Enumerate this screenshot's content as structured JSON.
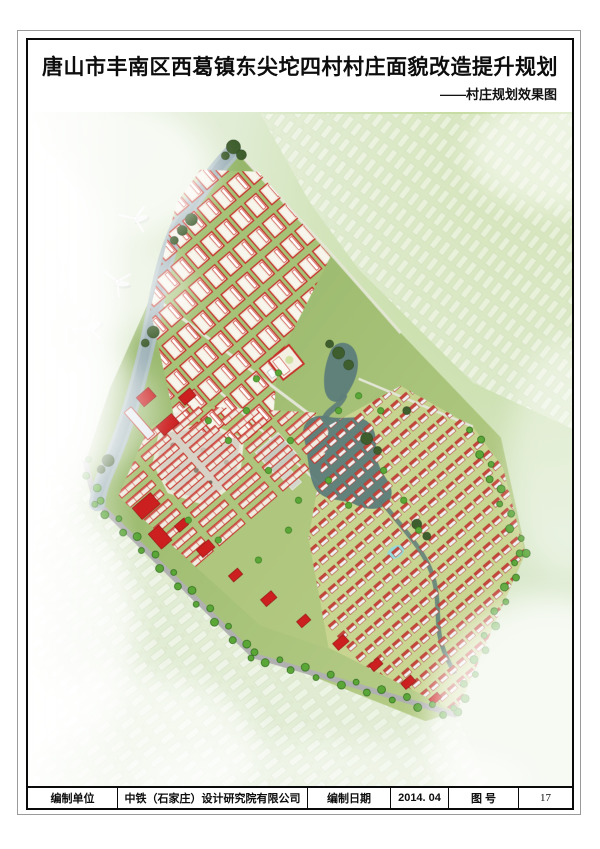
{
  "page": {
    "title": "唐山市丰南区西葛镇东尖坨四村村庄面貌改造提升规划",
    "subtitle": "——村庄规划效果图"
  },
  "footer": {
    "unit_label": "编制单位",
    "unit_value": "中铁（石家庄）设计研究院有限公司",
    "date_label": "编制日期",
    "date_value": "2014. 04",
    "figno_label": "图 号",
    "figno_value": "17"
  },
  "map": {
    "colors": {
      "bg_green_pale": "#dfeccf",
      "bg_green_bright": "#bdd794",
      "village_green_dark": "#8fb266",
      "village_green": "#a2bf74",
      "village_green_light": "#bcd08d",
      "river_blue": "#aebfc5",
      "river_core": "#93a9b0",
      "pond_teal": "#5d7c7a",
      "pond_cyan": "#8fd9e2",
      "house_red": "#c63028",
      "accent_red": "#cc1f1f",
      "house_wall": "#efe9da",
      "tree_dark": "#3f5e2d",
      "tree_bright": "#5aa637",
      "road_gray": "#b0b0b0",
      "path_light": "#e6e8d8",
      "rubble_gray": "#d8d2c6",
      "plaza_gray": "#c6cabf",
      "ghost_pale": "#edf2e2",
      "mist_white": "#ffffff"
    }
  }
}
